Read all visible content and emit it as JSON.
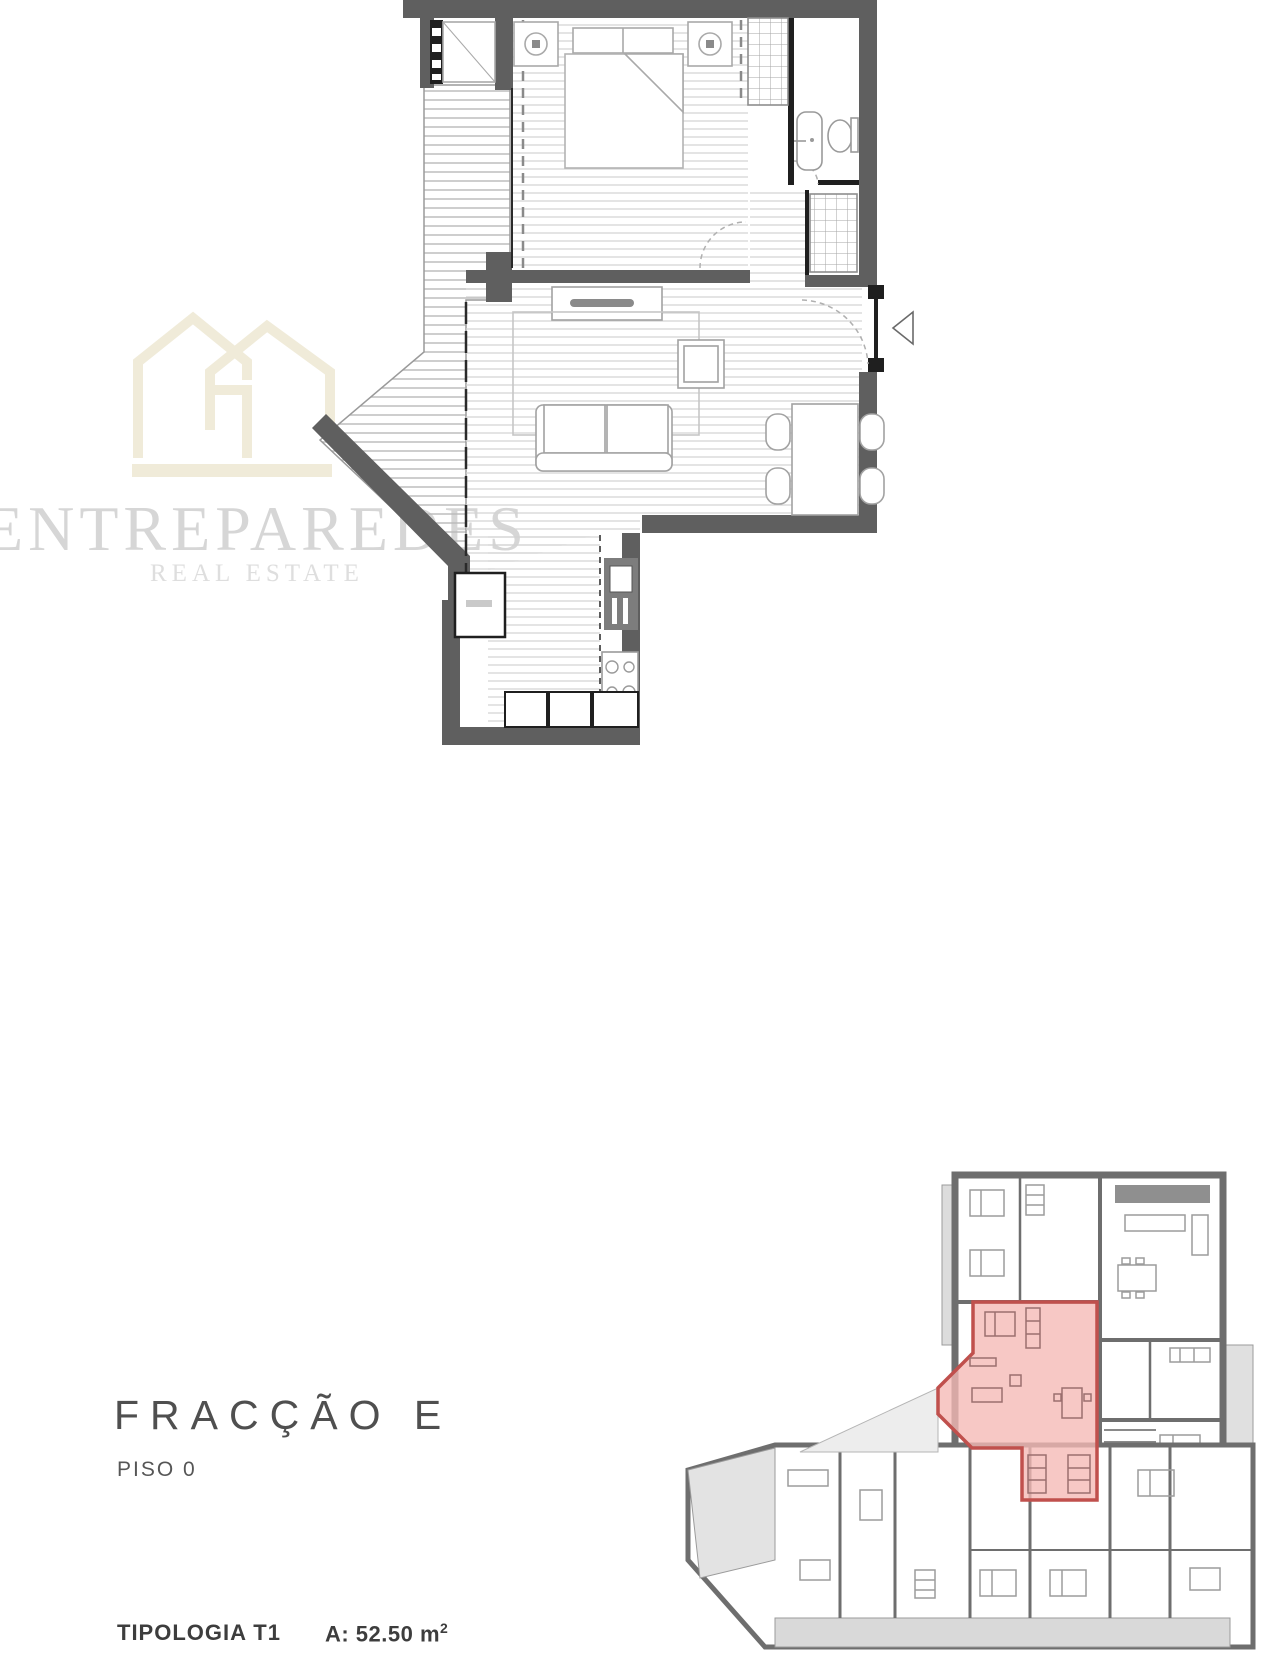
{
  "watermark": {
    "brand": "ENTREPAREDES",
    "tagline": "REAL ESTATE",
    "house_color": "#f0ebd9",
    "text_color": "#d6d6d6"
  },
  "unit_info": {
    "fraction": "FRACÇÃO E",
    "floor": "PISO 0",
    "typology": "TIPOLOGIA T1",
    "area_prefix": "A: 52.50 m",
    "area_sup": "2"
  },
  "colors": {
    "main_wall": "#5f5f5f",
    "partition": "#1f1f1f",
    "floor_stripe": "#d2d2d2",
    "furniture_line": "#9f9f9f",
    "overview_wall": "#6e6e6e",
    "highlight_fill": "#f5b9b5",
    "highlight_border": "#c0504d",
    "terrace_fill": "#dcdcdc"
  }
}
